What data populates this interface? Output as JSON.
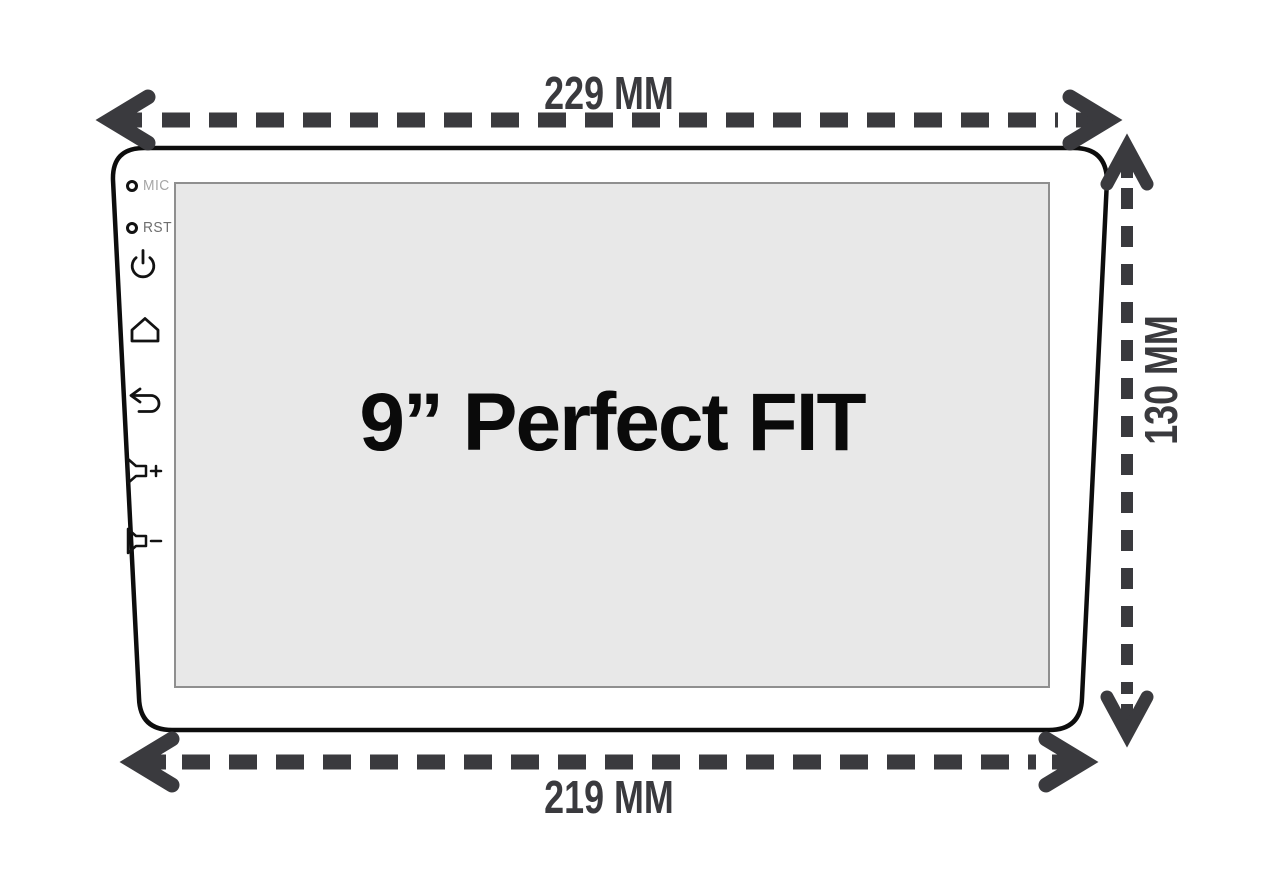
{
  "diagram": {
    "screen_title": "9” Perfect FIT",
    "dimensions": {
      "top_width": "229 MM",
      "bottom_width": "219 MM",
      "right_height": "130 MM"
    },
    "side_labels": {
      "mic": "MIC",
      "rst": "RST"
    },
    "side_controls": [
      "mic-hole",
      "reset-hole",
      "power",
      "home",
      "back",
      "volume-up",
      "volume-down"
    ],
    "colors": {
      "dimension_ink": "#3a3a3e",
      "bezel_outline": "#0d0d0d",
      "screen_fill": "#e8e8e8",
      "screen_border": "#8f8f8f",
      "title_ink": "#0a0a0a",
      "icon_ink": "#121212",
      "background": "#ffffff"
    }
  }
}
